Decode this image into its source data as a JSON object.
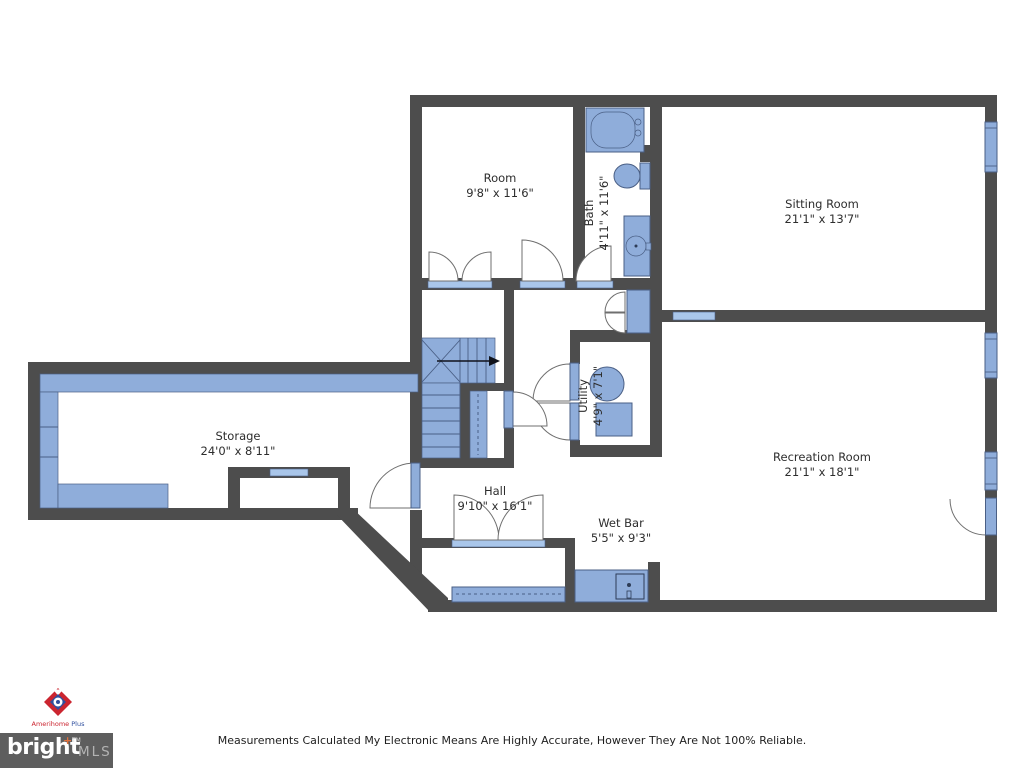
{
  "rooms": [
    {
      "name": "Room",
      "dims": "9'8\" x 11'6\""
    },
    {
      "name": "Bath",
      "dims": "4'11\" x 11'6\""
    },
    {
      "name": "Sitting Room",
      "dims": "21'1\" x 13'7\""
    },
    {
      "name": "Storage",
      "dims": "24'0\" x 8'11\""
    },
    {
      "name": "Utility",
      "dims": "4'9\" x 7'1\""
    },
    {
      "name": "Hall",
      "dims": "9'10\" x 16'1\""
    },
    {
      "name": "Wet Bar",
      "dims": "5'5\" x 9'3\""
    },
    {
      "name": "Recreation Room",
      "dims": "21'1\" x 18'1\""
    }
  ],
  "branding": {
    "agency_name_1": "Amerihome",
    "agency_name_2": "Plus",
    "mls_word": "bright",
    "mls_plus": "+",
    "mls_tm": "TM",
    "mls_suffix": "MLS"
  },
  "disclaimer": "Measurements Calculated My Electronic Means Are Highly Accurate, However They Are Not 100% Reliable.",
  "colors": {
    "wall": "#4d4d4d",
    "blue": "#8fadda",
    "blueline": "#4a5f85",
    "sill": "#a9c6ea",
    "text": "#2d2d2d",
    "red": "#cb2530",
    "navy": "#2f4f9e",
    "orange": "#e2703c",
    "mlsbox": "#5e5e5e",
    "mlsgray": "#b3b3b3"
  }
}
